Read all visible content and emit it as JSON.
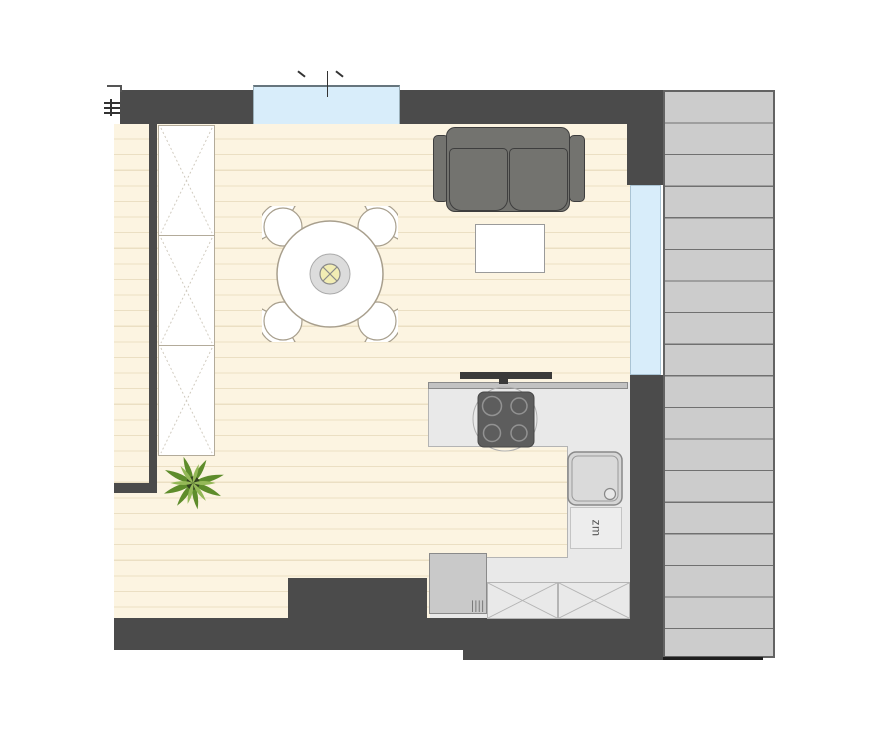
{
  "plan": {
    "labels": {
      "dishwasher": "zm"
    },
    "colors": {
      "wall": "#4b4b4b",
      "floor": "#fcf4e1",
      "floor_stripe": "#ebdfc3",
      "window": "#d8edfa",
      "deck": "#cccccc",
      "deck_line": "#707070",
      "kitchen": "#e9e9e9",
      "kitchen_line": "#b4b4b4",
      "counter_strip": "#c2c2c2",
      "dark_fixture": "#3a3a3a",
      "hob": "#5d5d5d",
      "burner": "#929292",
      "sofa": "#73736f",
      "sofa_border": "#3e3e3e",
      "furniture_border": "#a89f8d",
      "lamp_outer": "#dcdcdc",
      "lamp_inner": "#f2edb4",
      "sink": "#d6d6d6",
      "sink_border": "#888888",
      "appliance": "#c9c9c9",
      "plant_dark": "#5e8c2b",
      "plant_light": "#94b857",
      "plant_center": "#33421f",
      "mark": "#333333"
    }
  }
}
